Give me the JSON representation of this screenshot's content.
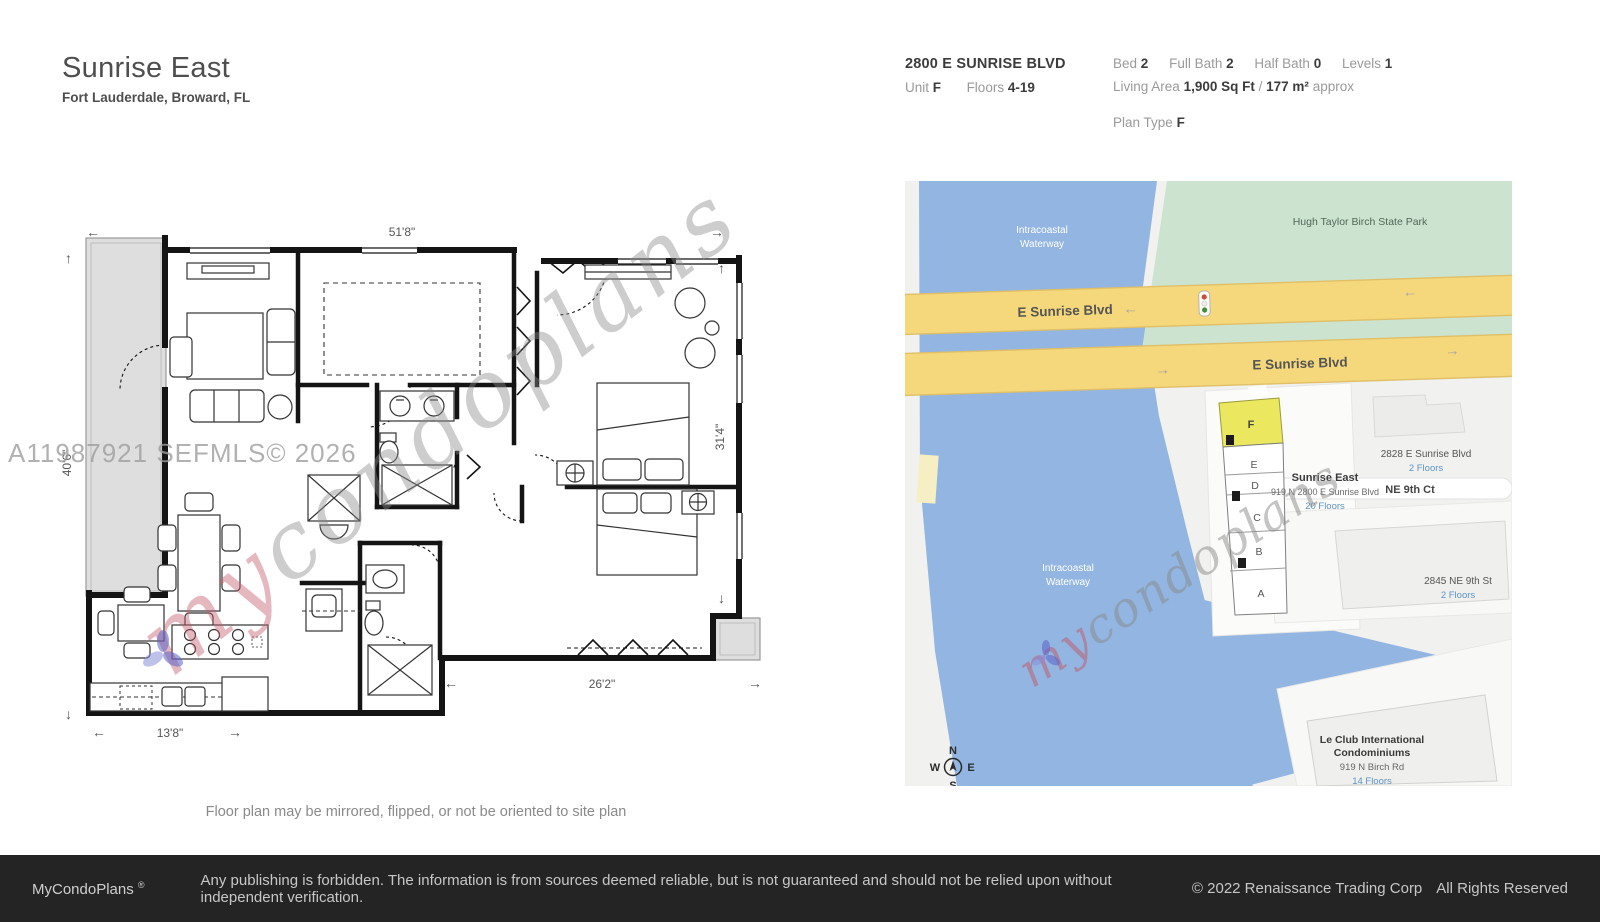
{
  "page": {
    "title": "Sunrise East",
    "subtitle": "Fort Lauderdale, Broward, FL",
    "caption": "Floor plan may be mirrored, flipped, or not be oriented to site plan"
  },
  "header": {
    "address": "2800 E SUNRISE BLVD",
    "unit_label": "Unit",
    "unit_value": "F",
    "floors_label": "Floors",
    "floors_value": "4-19",
    "stats": [
      {
        "label": "Bed",
        "value": "2"
      },
      {
        "label": "Full Bath",
        "value": "2"
      },
      {
        "label": "Half Bath",
        "value": "0"
      },
      {
        "label": "Levels",
        "value": "1"
      }
    ],
    "living_area_label": "Living Area",
    "living_area_value": "1,900 Sq Ft",
    "living_area_divider": "/",
    "living_area_metric": "177 m²",
    "living_area_approx": "approx",
    "plan_type_label": "Plan Type",
    "plan_type_value": "F"
  },
  "floor_plan": {
    "dimensions": {
      "top": "51'8\"",
      "left": "40'6\"",
      "right": "31'4\"",
      "bottom_right": "26'2\"",
      "bottom_left": "13'8\""
    },
    "watermark_mls": "A11987921  SEFMLS© 2026"
  },
  "watermark": {
    "script_prefix": "my",
    "script_suffix": "condoplans"
  },
  "map": {
    "water_label_line1": "Intracoastal",
    "water_label_line2": "Waterway",
    "park_label": "Hugh Taylor Birch State Park",
    "road_label": "E Sunrise Blvd",
    "road_ne9ct": "NE 9th Ct",
    "building_2828": {
      "name": "2828 E Sunrise Blvd",
      "floors": "2 Floors"
    },
    "subject": {
      "name": "Sunrise East",
      "address": "919 N 2800 E Sunrise Blvd",
      "floors": "20 Floors"
    },
    "building_2845": {
      "name": "2845 NE 9th St",
      "floors": "2 Floors"
    },
    "building_leclub": {
      "name_line1": "Le Club International",
      "name_line2": "Condominiums",
      "address": "919 N Birch Rd",
      "floors": "14 Floors"
    },
    "unit_labels": [
      "F",
      "E",
      "D",
      "C",
      "B",
      "A"
    ],
    "compass": {
      "n": "N",
      "s": "S",
      "e": "E",
      "w": "W"
    },
    "colors": {
      "water": "#92B5E1",
      "park": "#CCE4CF",
      "road": "#F5D87B",
      "road_border": "#E0BF66",
      "unit_highlight": "#EBE75E",
      "floors_text": "#5E93C4"
    }
  },
  "footer": {
    "brand": "MyCondoPlans",
    "reg": "®",
    "disclaimer": "Any publishing is forbidden. The information is from sources deemed reliable, but is not guaranteed and should not be relied upon without independent verification.",
    "copyright": "© 2022 Renaissance Trading Corp",
    "rights": "All Rights Reserved"
  }
}
